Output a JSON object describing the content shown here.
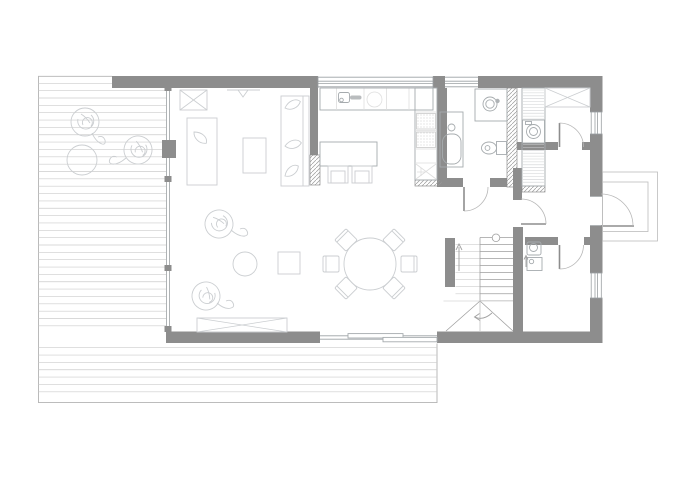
{
  "meta": {
    "type": "architectural floor plan drawing (ground floor)",
    "visible_text": []
  },
  "colors": {
    "background": "#ffffff",
    "wall": "#8d8d8d",
    "wall_hatch": "#9a9a9a",
    "glass": "#9ba0a3",
    "furniture": "#cbced1",
    "fixture": "#a6abae",
    "deck": "#cccccc",
    "deck_edge": "#b3b3b3",
    "stair": "#9e9e9e",
    "stair_faint": "#d6d6d6",
    "door_arc": "#b7b7b7",
    "appliance_stipple": "#b9b9b9"
  },
  "rooms": [
    "deck-terrace",
    "living-room",
    "dining-area",
    "kitchen",
    "hallway",
    "bathroom",
    "utility-closet",
    "entry-hall",
    "wc",
    "staircase",
    "entrance-porch"
  ],
  "symbols": [
    "deck-boards",
    "planter-plant",
    "round-planter",
    "storage-cabinet-x",
    "pendant-light",
    "daybed",
    "rug",
    "sofa",
    "pouf",
    "side-table",
    "bench-x",
    "kitchen-counter",
    "kitchen-sink",
    "cooktop",
    "oven-stack",
    "fridge-column",
    "kitchen-island",
    "bar-stool",
    "dining-table",
    "dining-chair",
    "bathtub",
    "washbasin",
    "toilet",
    "washing-machine",
    "shelf-column",
    "wardrobe-x",
    "stair-flight",
    "winder-steps",
    "direction-arrow",
    "door-swing",
    "window",
    "sliding-glass-door",
    "glass-facade",
    "entrance-door",
    "porch-steps"
  ]
}
